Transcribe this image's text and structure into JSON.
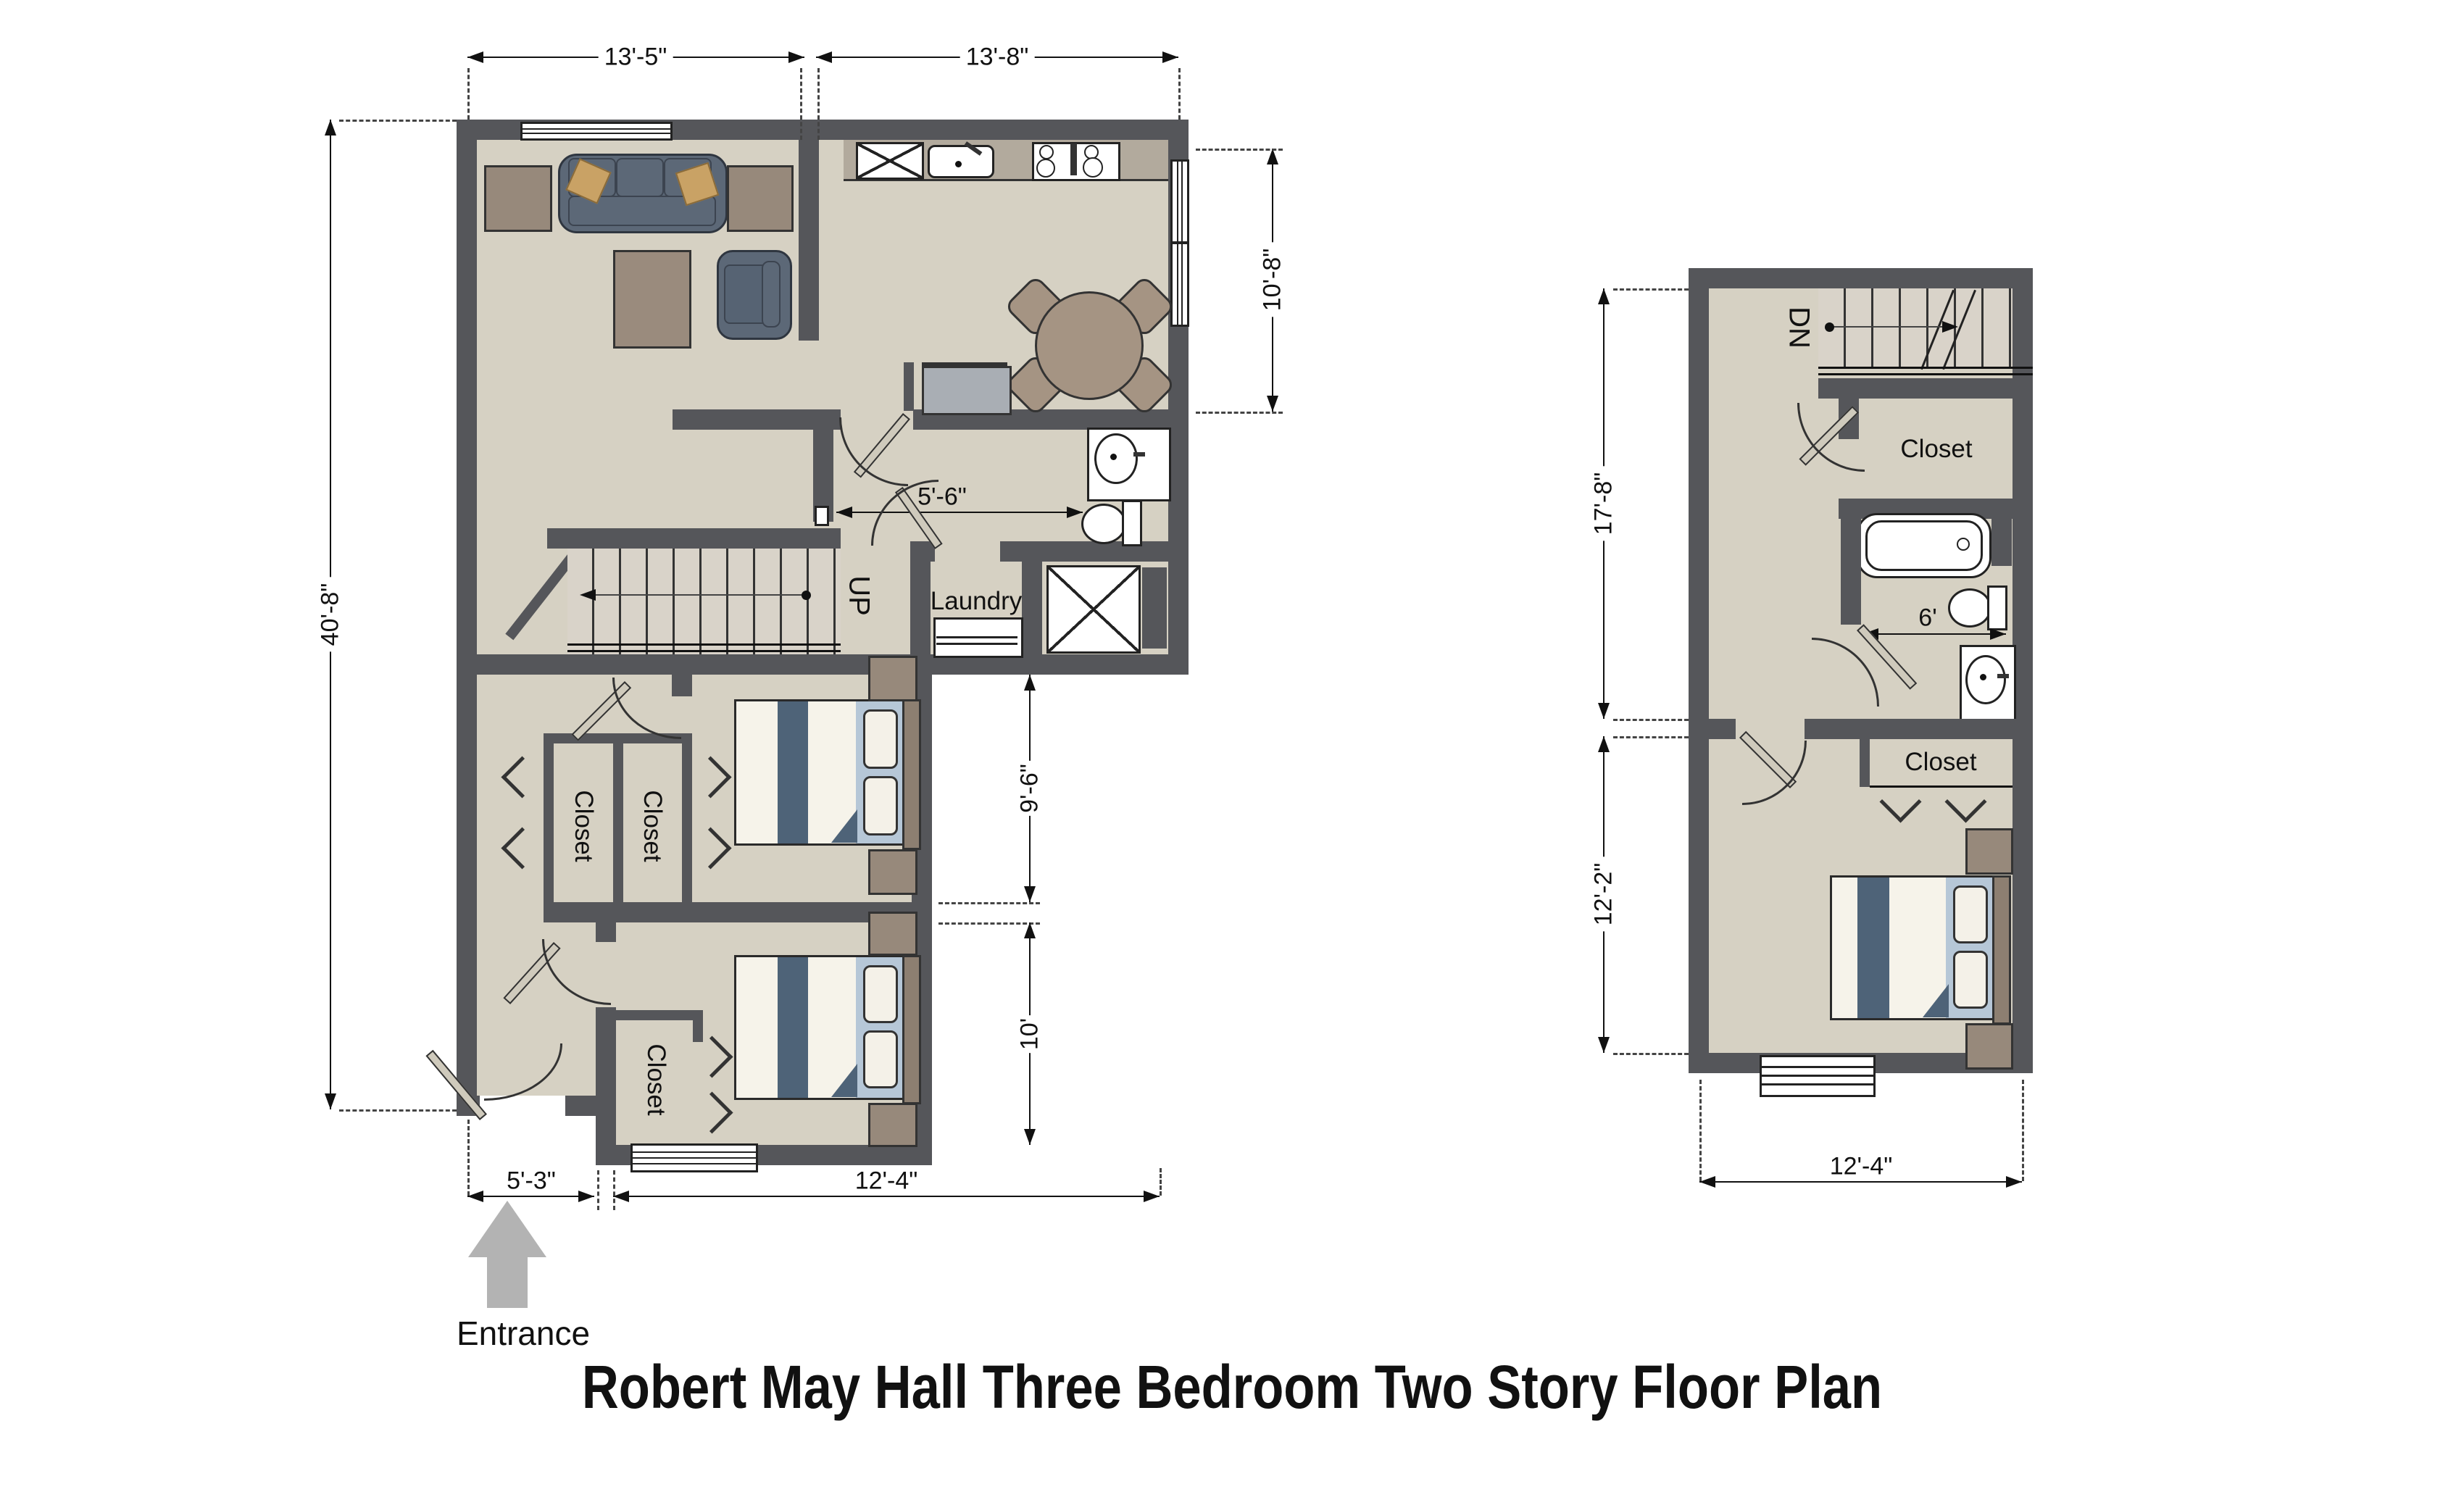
{
  "title": "Robert May Hall Three Bedroom Two Story Floor Plan",
  "entrance_label": "Entrance",
  "first_floor": {
    "dims": {
      "top_left": "13'-5\"",
      "top_right": "13'-8\"",
      "left": "40'-8\"",
      "kitchen_right": "10'-8\"",
      "bath": "5'-6\"",
      "bedroom1": "9'-6\"",
      "bedroom2": "10'",
      "bottom_left": "5'-3\"",
      "bottom_right": "12'-4\""
    },
    "labels": {
      "up": "UP",
      "laundry": "Laundry",
      "closet_left": "Closet",
      "closet_right": "Closet",
      "closet_bottom": "Closet"
    }
  },
  "second_floor": {
    "dims": {
      "upper_left": "17'-8\"",
      "lower_left": "12'-2\"",
      "bath": "6'",
      "bottom": "12'-4\""
    },
    "labels": {
      "dn": "DN",
      "closet_upper": "Closet",
      "closet_lower": "Closet"
    }
  },
  "colors": {
    "wall": "#55565a",
    "floor": "#d6d1c3",
    "counter": "#b2aa9d",
    "wood": "#97897b",
    "sofa": "#5c6877",
    "accent_pillow": "#c9a265",
    "bed_stripe": "#4e6378",
    "bed_blanket": "#b6c7d7",
    "entrance_arrow": "#b3b3b3"
  }
}
